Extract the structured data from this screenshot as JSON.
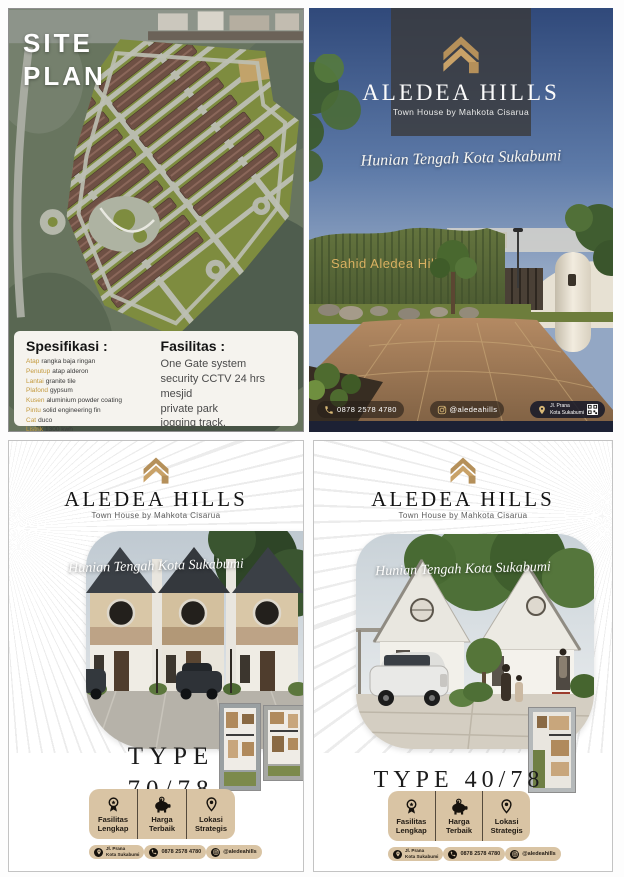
{
  "brand": {
    "name": "ALEDEA HILLS",
    "subtitle": "Town House by Mahkota Cisarua",
    "tagline": "Hunian Tengah Kota Sukabumi"
  },
  "site_plan": {
    "title_line1": "SITE",
    "title_line2": "PLAN",
    "spesifikasi_heading": "Spesifikasi :",
    "spec_items": [
      {
        "label": "Atap",
        "value": "rangka baja ringan"
      },
      {
        "label": "Penutup",
        "value": "atap alderon"
      },
      {
        "label": "Lantai",
        "value": "granite tile"
      },
      {
        "label": "Plafond",
        "value": "gypsum"
      },
      {
        "label": "Kusen",
        "value": "aluminium powder coating"
      },
      {
        "label": "Pintu",
        "value": "solid engineering fin"
      },
      {
        "label": "Cat",
        "value": "duco"
      },
      {
        "label": "Listrik",
        "value": "1300 kwh"
      },
      {
        "label": "Sumber air",
        "value": "sumur bor"
      }
    ],
    "fasilitas_heading": "Fasilitas :",
    "fasilitas_items": [
      "One Gate system",
      "security CCTV 24 hrs",
      "mesjid",
      "private park",
      "jogging track."
    ]
  },
  "gate": {
    "sign": "Sahid Aledea Hills"
  },
  "contact": {
    "phone": "0878 2578 4780",
    "instagram": "@aledeahills",
    "address_line1": "Jl. Prana",
    "address_line2": "Kota Sukabumi"
  },
  "badges": [
    {
      "line1": "Fasilitas",
      "line2": "Lengkap"
    },
    {
      "line1": "Harga",
      "line2": "Terbaik"
    },
    {
      "line1": "Lokasi",
      "line2": "Strategis"
    }
  ],
  "type70": {
    "line1": "TYPE",
    "line2": "70/78"
  },
  "type40": {
    "label": "TYPE 40/78"
  },
  "colors": {
    "gold": "#b5905a",
    "beige": "#d9c4a4",
    "navy": "#1c2134",
    "spec_label": "#c49a3e"
  }
}
